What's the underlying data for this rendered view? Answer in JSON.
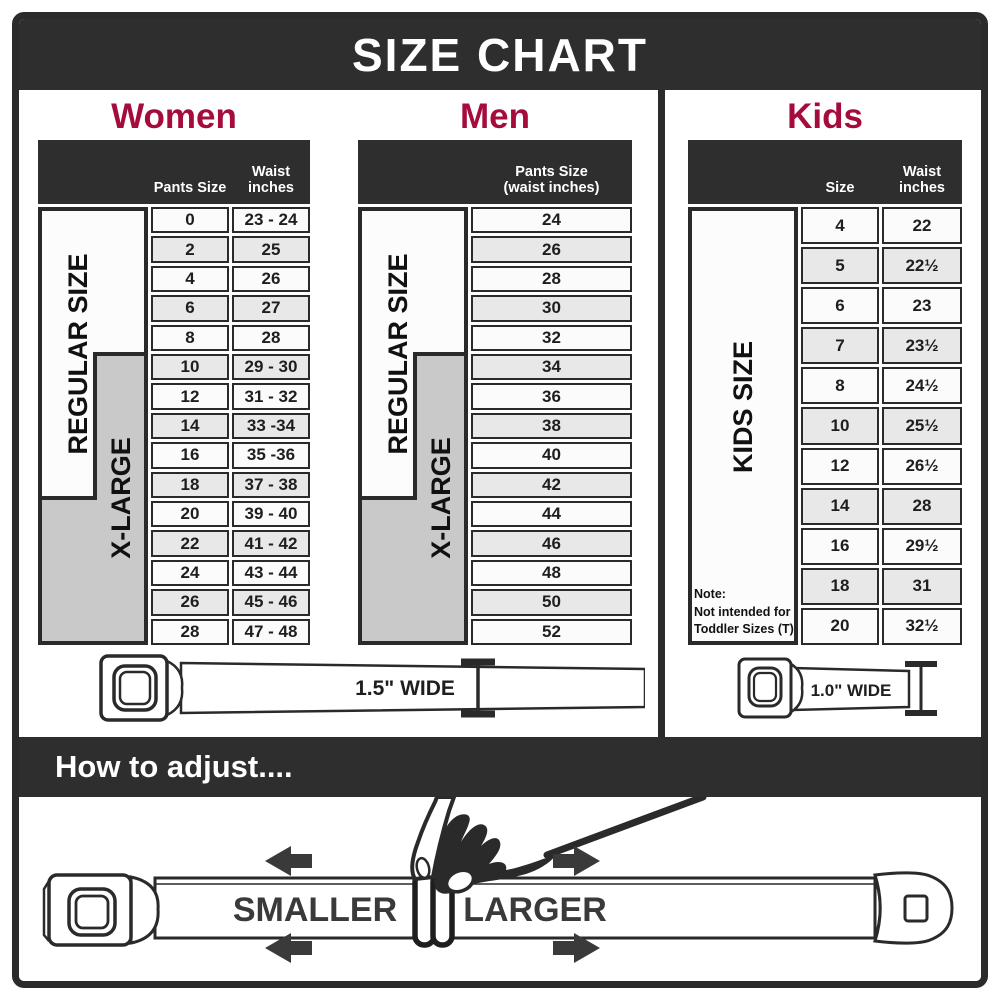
{
  "title": "SIZE CHART",
  "colors": {
    "accent": "#A50C3C",
    "dark": "#2E2E2E",
    "row": "#FBFBFB",
    "row_alt": "#E8E8E8",
    "xlarge_box": "#C9C9C9"
  },
  "women": {
    "heading": "Women",
    "col_size": "Pants Size",
    "col_waist_line1": "Waist",
    "col_waist_line2": "inches",
    "label_regular": "REGULAR SIZE",
    "label_xlarge": "X-LARGE",
    "rows": [
      [
        "0",
        "23 - 24"
      ],
      [
        "2",
        "25"
      ],
      [
        "4",
        "26"
      ],
      [
        "6",
        "27"
      ],
      [
        "8",
        "28"
      ],
      [
        "10",
        "29 - 30"
      ],
      [
        "12",
        "31 - 32"
      ],
      [
        "14",
        "33 -34"
      ],
      [
        "16",
        "35 -36"
      ],
      [
        "18",
        "37 - 38"
      ],
      [
        "20",
        "39 - 40"
      ],
      [
        "22",
        "41 - 42"
      ],
      [
        "24",
        "43 - 44"
      ],
      [
        "26",
        "45 - 46"
      ],
      [
        "28",
        "47 - 48"
      ]
    ]
  },
  "men": {
    "heading": "Men",
    "col_header_line1": "Pants Size",
    "col_header_line2": "(waist inches)",
    "label_regular": "REGULAR SIZE",
    "label_xlarge": "X-LARGE",
    "rows": [
      [
        "24"
      ],
      [
        "26"
      ],
      [
        "28"
      ],
      [
        "30"
      ],
      [
        "32"
      ],
      [
        "34"
      ],
      [
        "36"
      ],
      [
        "38"
      ],
      [
        "40"
      ],
      [
        "42"
      ],
      [
        "44"
      ],
      [
        "46"
      ],
      [
        "48"
      ],
      [
        "50"
      ],
      [
        "52"
      ]
    ]
  },
  "kids": {
    "heading": "Kids",
    "col_size": "Size",
    "col_waist_line1": "Waist",
    "col_waist_line2": "inches",
    "label": "KIDS SIZE",
    "note_line1": "Note:",
    "note_line2": "Not intended for",
    "note_line3": "Toddler Sizes (T)",
    "rows": [
      [
        "4",
        "22"
      ],
      [
        "5",
        "22½"
      ],
      [
        "6",
        "23"
      ],
      [
        "7",
        "23½"
      ],
      [
        "8",
        "24½"
      ],
      [
        "10",
        "25½"
      ],
      [
        "12",
        "26½"
      ],
      [
        "14",
        "28"
      ],
      [
        "16",
        "29½"
      ],
      [
        "18",
        "31"
      ],
      [
        "20",
        "32½"
      ]
    ]
  },
  "belts": {
    "adult_width_label": "1.5\" WIDE",
    "kids_width_label": "1.0\" WIDE"
  },
  "adjust": {
    "heading": "How to adjust....",
    "smaller": "SMALLER",
    "larger": "LARGER"
  },
  "chart_data": [
    {
      "type": "table",
      "title": "Women",
      "columns": [
        "Pants Size",
        "Waist inches"
      ],
      "rows": [
        [
          "0",
          "23 - 24"
        ],
        [
          "2",
          "25"
        ],
        [
          "4",
          "26"
        ],
        [
          "6",
          "27"
        ],
        [
          "8",
          "28"
        ],
        [
          "10",
          "29 - 30"
        ],
        [
          "12",
          "31 - 32"
        ],
        [
          "14",
          "33 -34"
        ],
        [
          "16",
          "35 -36"
        ],
        [
          "18",
          "37 - 38"
        ],
        [
          "20",
          "39 - 40"
        ],
        [
          "22",
          "41 - 42"
        ],
        [
          "24",
          "43 - 44"
        ],
        [
          "26",
          "45 - 46"
        ],
        [
          "28",
          "47 - 48"
        ]
      ],
      "row_groups": {
        "REGULAR SIZE": [
          "0",
          "18"
        ],
        "X-LARGE": [
          "10",
          "28"
        ]
      },
      "belt_width": "1.5\" WIDE"
    },
    {
      "type": "table",
      "title": "Men",
      "columns": [
        "Pants Size (waist inches)"
      ],
      "rows": [
        [
          "24"
        ],
        [
          "26"
        ],
        [
          "28"
        ],
        [
          "30"
        ],
        [
          "32"
        ],
        [
          "34"
        ],
        [
          "36"
        ],
        [
          "38"
        ],
        [
          "40"
        ],
        [
          "42"
        ],
        [
          "44"
        ],
        [
          "46"
        ],
        [
          "48"
        ],
        [
          "50"
        ],
        [
          "52"
        ]
      ],
      "row_groups": {
        "REGULAR SIZE": [
          "24",
          "42"
        ],
        "X-LARGE": [
          "34",
          "52"
        ]
      },
      "belt_width": "1.5\" WIDE"
    },
    {
      "type": "table",
      "title": "Kids",
      "columns": [
        "Size",
        "Waist inches"
      ],
      "rows": [
        [
          "4",
          "22"
        ],
        [
          "5",
          "22½"
        ],
        [
          "6",
          "23"
        ],
        [
          "7",
          "23½"
        ],
        [
          "8",
          "24½"
        ],
        [
          "10",
          "25½"
        ],
        [
          "12",
          "26½"
        ],
        [
          "14",
          "28"
        ],
        [
          "16",
          "29½"
        ],
        [
          "18",
          "31"
        ],
        [
          "20",
          "32½"
        ]
      ],
      "row_groups": {
        "KIDS SIZE": [
          "4",
          "20"
        ]
      },
      "note": "Note: Not intended for Toddler Sizes (T)",
      "belt_width": "1.0\" WIDE"
    }
  ]
}
